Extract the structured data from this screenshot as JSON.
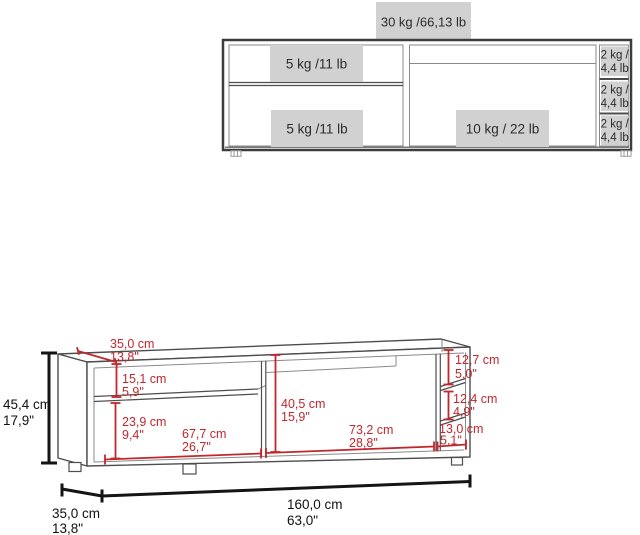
{
  "front_view": {
    "top_capacity": "30 kg /66,13 lb",
    "upper_left_shelf": "5 kg /11 lb",
    "lower_left_shelf": "5 kg /11 lb",
    "right_shelf": "10 kg / 22 lb",
    "compartments": [
      {
        "kg": "2 kg /",
        "lb": "4,4 lb"
      },
      {
        "kg": "2 kg /",
        "lb": "4,4 lb"
      },
      {
        "kg": "2 kg /",
        "lb": "4,4 lb"
      }
    ]
  },
  "perspective_view": {
    "overall_height": {
      "cm": "45,4 cm",
      "in": "17,9\""
    },
    "top_depth": {
      "cm": "35,0 cm",
      "in": "13,8\""
    },
    "upper_opening_height": {
      "cm": "15,1 cm",
      "in": "5,9\""
    },
    "lower_opening_height": {
      "cm": "23,9 cm",
      "in": "9,4\""
    },
    "left_opening_width": {
      "cm": "67,7 cm",
      "in": "26,7\""
    },
    "center_opening_height": {
      "cm": "40,5 cm",
      "in": "15,9\""
    },
    "center_opening_width": {
      "cm": "73,2 cm",
      "in": "28,8\""
    },
    "cubby_top_height": {
      "cm": "12,7 cm",
      "in": "5,0\""
    },
    "cubby_middle_height": {
      "cm": "12,4 cm",
      "in": "4,9\""
    },
    "cubby_width": {
      "cm": "13,0 cm",
      "in": "5,1\""
    },
    "base_depth": {
      "cm": "35,0 cm",
      "in": "13,8\""
    },
    "overall_width": {
      "cm": "160,0 cm",
      "in": "63,0\""
    }
  },
  "colors": {
    "dimension_red": "#c1272d",
    "label_box_gray": "#d1d1d1",
    "outline_dark": "#3d3d3d"
  }
}
